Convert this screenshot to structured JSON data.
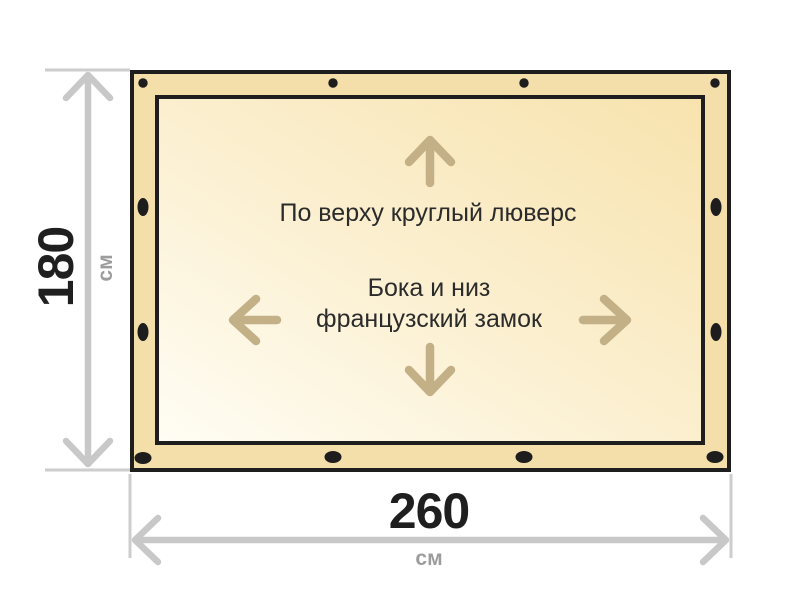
{
  "diagram": {
    "annotations": {
      "top_edge": "По верху круглый люверс",
      "sides_line1": "Бока и низ",
      "sides_line2": "французский замок"
    },
    "height_dimension": {
      "value": "180",
      "unit": "см"
    },
    "width_dimension": {
      "value": "260",
      "unit": "см"
    },
    "grommet_count": 12,
    "icons": {
      "up": "arrow-up-icon",
      "down": "arrow-down-icon",
      "left": "arrow-left-icon",
      "right": "arrow-right-icon",
      "grommet": "grommet-dot-icon"
    },
    "colors": {
      "panel_border": "#1e1e1e",
      "panel_band": "#f4dfab",
      "inner_gradient_start": "#fffdf4",
      "inner_gradient_end": "#f8e3ae",
      "direction_arrow": "#c3b087",
      "dimension_line": "#c8c8c8",
      "dimension_value_text": "#1f1f1f",
      "unit_label_text": "#9c9c9c",
      "annotation_text": "#2b2b2b"
    }
  }
}
